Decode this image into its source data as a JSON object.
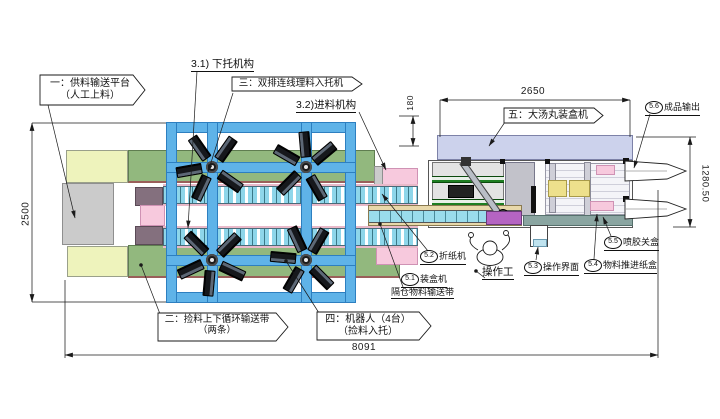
{
  "dimensions": {
    "left_height": "2500",
    "infeed_offset": "180",
    "cartoner_length": "2650",
    "cartoner_width": "1280.50",
    "total_length": "8091"
  },
  "callouts": {
    "c1": {
      "line1": "一：供料输送平台",
      "line2": "（人工上料）"
    },
    "c2": {
      "line1": "二：捡料上下循环输送带",
      "line2": "（两条）"
    },
    "c3": {
      "line1": "三：双排连线理料入托机"
    },
    "c4": {
      "line1": "四：机器人（4台）",
      "line2": "（捡料入托）"
    },
    "c5": {
      "line1": "五：大汤丸装盒机"
    }
  },
  "labels": {
    "l31": "3.1) 下托机构",
    "l32": "3.2)进料机构",
    "operator": "操作工"
  },
  "balloons": {
    "b51": {
      "num": "5.1",
      "text": "装盒机",
      "text2": "隔仓物料输送带"
    },
    "b52": {
      "num": "5.2",
      "text": "折纸机"
    },
    "b53": {
      "num": "5.3",
      "text": "操作界面"
    },
    "b54": {
      "num": "5.4",
      "text": "物料推进纸盒"
    },
    "b55": {
      "num": "5.5",
      "text": "喷胶关盒"
    },
    "b56": {
      "num": "5.6",
      "text": "成品输出"
    }
  },
  "colors": {
    "frame_blue": "#5fb3e8",
    "conveyor_cyan": "#8ed6ea",
    "platform_light_green": "#eef3bc",
    "belt_green": "#92b87e",
    "platform_gray": "#cbcbcb",
    "pink": "#f7c9dd",
    "mauve": "#84707e",
    "cartoner_lavender": "#ccd2ec",
    "tray_conveyor_tan": "#e8d8aa",
    "teal_strip": "#8aa5a1",
    "yellow_block": "#ede08c",
    "purple_block": "#b564c2"
  }
}
